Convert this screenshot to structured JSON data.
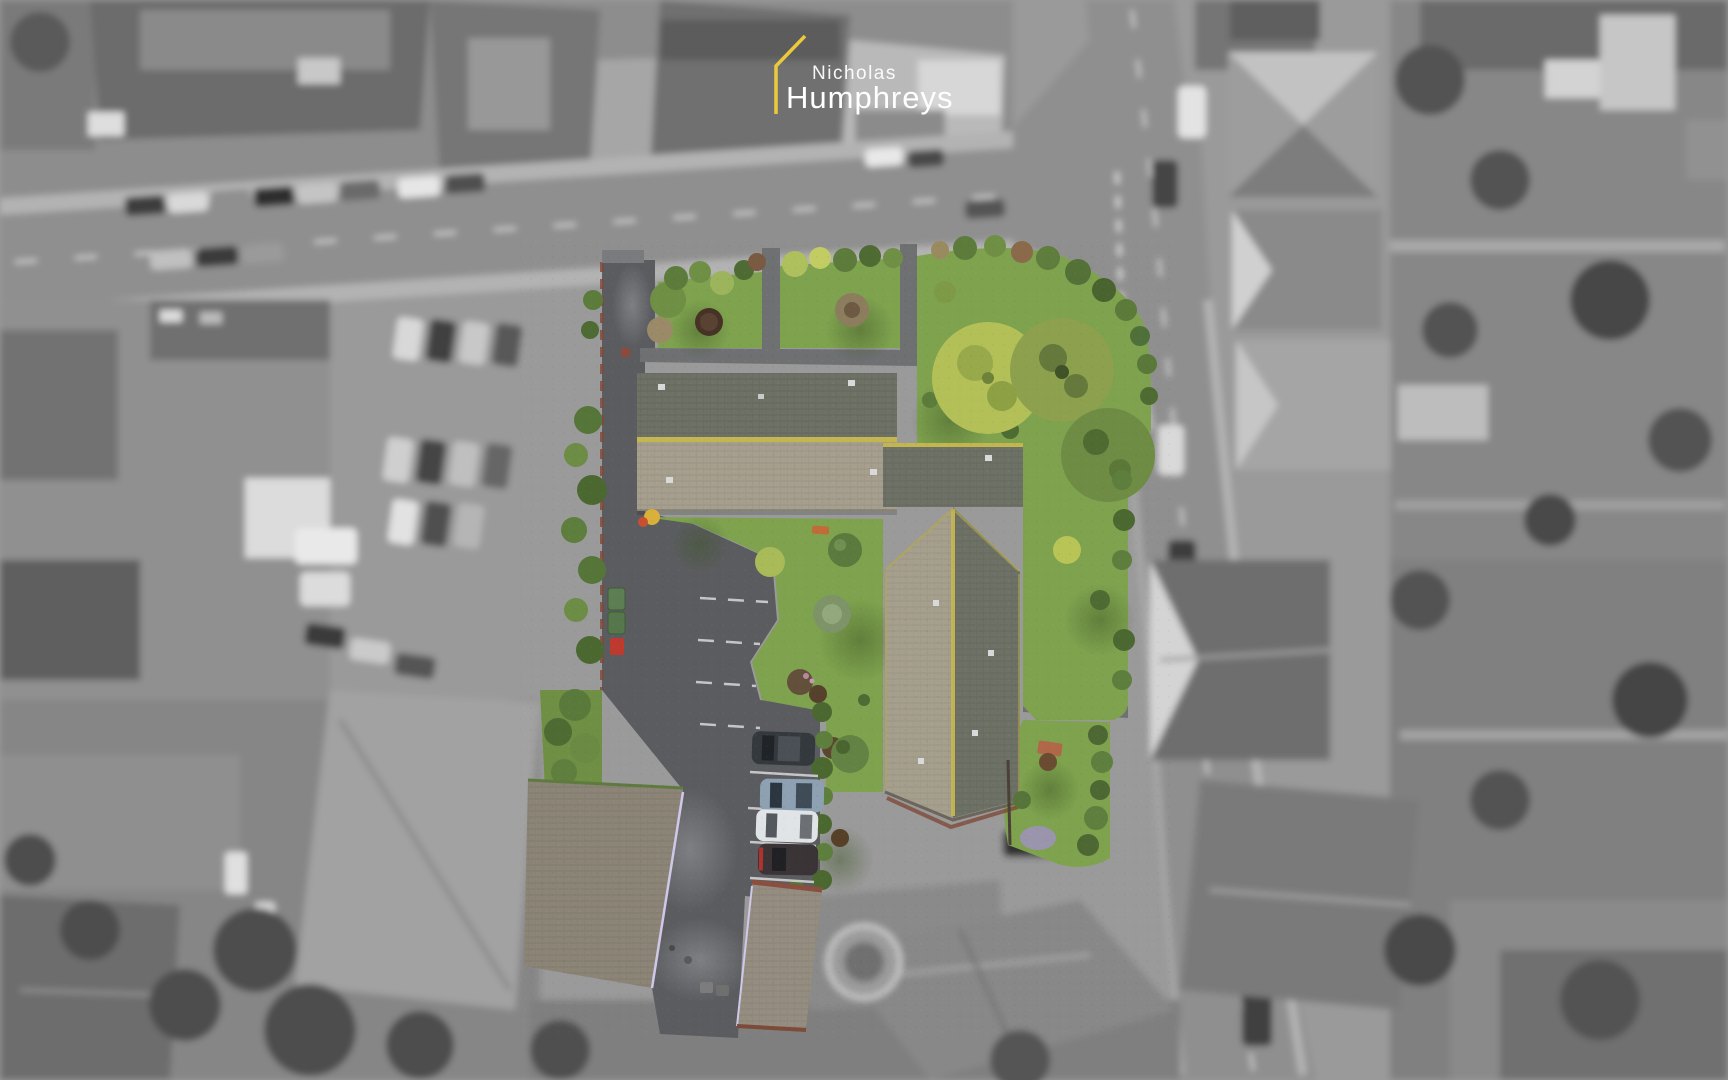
{
  "logo": {
    "name_line1": "Nicholas",
    "name_line2": "Humphreys"
  },
  "colors": {
    "brand_yellow": "#EBC93D",
    "logo_white": "#FFFFFF",
    "lawn_green": "#7EA24E",
    "lawn_shadow": "#5F7C3A",
    "hedge_green": "#4F6B34",
    "tree_lime": "#B3C058",
    "tree_olive": "#8DA04E",
    "tree_forest": "#6F8C44",
    "roof_slope_dark": "#6E7266",
    "roof_slope_light": "#A69F8E",
    "roof_lichen_yellow": "#C4B64F",
    "garage_roof": "#8B8477",
    "asphalt_dark": "#5B5C60",
    "asphalt_light": "#77787B",
    "path_gray": "#6E7072",
    "brick_red": "#7E4A3A",
    "marking_white": "#D9D9D9",
    "car_navy": "#34393D",
    "car_steel_blue": "#8DA1B3",
    "car_white": "#E1E4E7",
    "car_black": "#3A3437",
    "bin_green": "#5D7E52",
    "bin_red": "#BF3A2E",
    "gray_road": "#8F8F8F",
    "gray_sidewalk": "#B3B3B3",
    "gray_base": "#9A9A9A",
    "gray_roof_dark": "#6C6C6C",
    "gray_roof_light": "#C2C2C2",
    "gray_tree": "#4D4D4D"
  }
}
